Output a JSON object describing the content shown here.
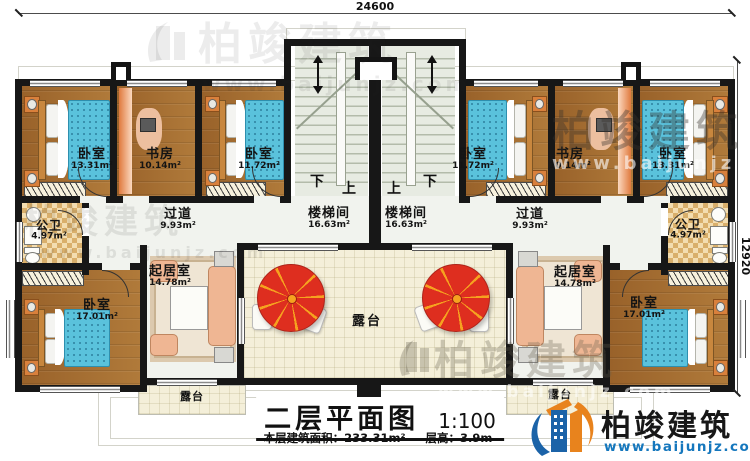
{
  "dimensions": {
    "top": "24600",
    "right": "12920"
  },
  "title_block": {
    "title": "二层平面图",
    "scale": "1:100",
    "area_label": "本层建筑面积：",
    "area_value": "233.31m²",
    "floor_height_label": "层高：",
    "floor_height_value": "3.9m"
  },
  "brand": {
    "name": "柏竣建筑",
    "website": "www.baijunjz.com"
  },
  "watermark": {
    "name": "柏竣建筑",
    "website": "www.baijunjz.com"
  },
  "stair_labels": {
    "down": "下",
    "up": "上"
  },
  "rooms": {
    "bedroom_top_left": {
      "name": "卧室",
      "area": "13.31m²"
    },
    "study_left": {
      "name": "书房",
      "area": "10.14m²"
    },
    "bedroom_mid_left": {
      "name": "卧室",
      "area": "11.72m²"
    },
    "stairwell_left": {
      "name": "楼梯间",
      "area": "16.63m²"
    },
    "corridor_left": {
      "name": "过道",
      "area": "9.93m²"
    },
    "bath_left": {
      "name": "公卫",
      "area": "4.97m²"
    },
    "bedroom_bottom_left": {
      "name": "卧室",
      "area": "17.01m²"
    },
    "living_left": {
      "name": "起居室",
      "area": "14.78m²"
    },
    "bedroom_mid_right": {
      "name": "卧室",
      "area": "11.72m²"
    },
    "study_right": {
      "name": "书房",
      "area": "10.14m²"
    },
    "bedroom_top_right": {
      "name": "卧室",
      "area": "13.31m²"
    },
    "stairwell_right": {
      "name": "楼梯间",
      "area": "16.63m²"
    },
    "corridor_right": {
      "name": "过道",
      "area": "9.93m²"
    },
    "bath_right": {
      "name": "公卫",
      "area": "4.97m²"
    },
    "bedroom_bottom_right": {
      "name": "卧室",
      "area": "17.01m²"
    },
    "living_right": {
      "name": "起居室",
      "area": "14.78m²"
    },
    "terrace_center": {
      "name": "露台"
    },
    "terrace_bottom_left": {
      "name": "露台"
    },
    "terrace_bottom_right": {
      "name": "露台"
    }
  }
}
